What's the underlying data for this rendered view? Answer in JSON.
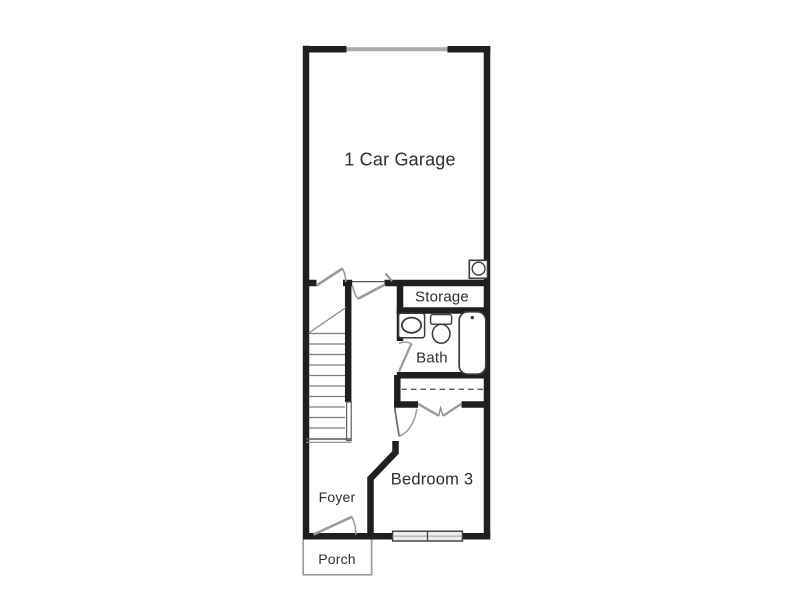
{
  "floorplan": {
    "rooms": {
      "garage": "1 Car Garage",
      "storage": "Storage",
      "bath": "Bath",
      "bedroom3": "Bedroom 3",
      "foyer": "Foyer",
      "porch": "Porch"
    },
    "fixtures": [
      "stairs",
      "water-heater",
      "sink-vanity",
      "toilet",
      "bathtub",
      "window",
      "closet-double-doors",
      "closet-shelf-dashed",
      "door-swings",
      "garage-door"
    ],
    "colors": {
      "background": "#ffffff",
      "wall": "#1f1f1f",
      "door_swing": "#9b9b9b",
      "garage_door": "#ababab",
      "fixture_outline": "#3a3a3a",
      "stair_tread": "#7d7d7d",
      "window_fill": "#ebebeb",
      "porch_outline": "#9c9c9c",
      "label_text": "#2e2e2e"
    }
  }
}
